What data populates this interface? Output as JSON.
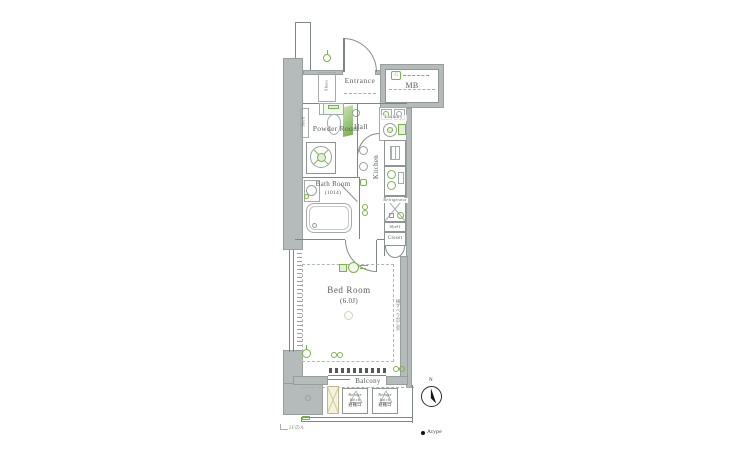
{
  "rooms": {
    "entrance": "Entrance",
    "mb": "MB",
    "shoes": "Shoes",
    "ps": "PS",
    "hall": "Hall",
    "laundry": "Laundry",
    "powder_room": "Powder Room",
    "bath_room": "Bath Room",
    "bath_size": "(1014)",
    "kitchen": "Kitchen",
    "refrigerator": "Refrigerator",
    "shelf_side": "Shelf",
    "shelf_top": "Shelf",
    "closet": "Closet",
    "bed_room": "Bed Room",
    "bed_room_size": "(6.0J)",
    "balcony": "Balcony"
  },
  "annotations": {
    "compass_n": "N",
    "type_legend": "Atype",
    "stairs_note": "2FのA",
    "window_note": "横すべり出し窓",
    "mb_meter_tag": "G",
    "refuge": {
      "l1": "Refuge",
      "l2": "hatch",
      "left_sub": "避難口",
      "right_sub": "避難口"
    }
  },
  "colors": {
    "wall": "#b5baba",
    "line": "#7e8686",
    "accent_green": "#79b445",
    "light_green": "#e4efdb",
    "text": "#565c5c"
  }
}
